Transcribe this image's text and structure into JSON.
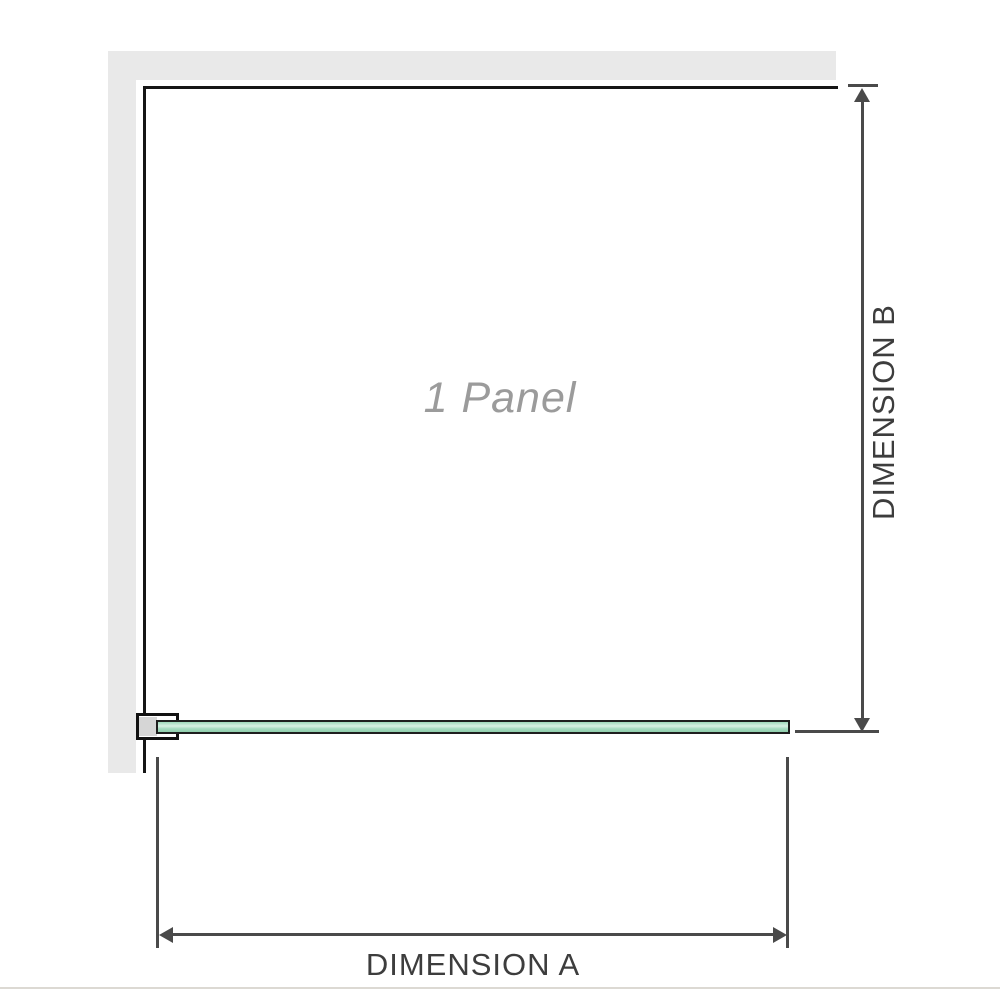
{
  "diagram": {
    "panel_label": "1 Panel",
    "dimension_a_label": "DIMENSION A",
    "dimension_b_label": "DIMENSION B"
  },
  "colors": {
    "background": "#ffffff",
    "wall_fill": "#e9e9e9",
    "panel_outline": "#161616",
    "glass_border": "#1e1e1e",
    "glass_green_light": "#d8f0e3",
    "glass_green": "#a5dabf",
    "glass_green_dark": "#8fceac",
    "bracket_outline": "#111111",
    "bracket_fill": "#ffffff",
    "bracket_insert": "#d6d6d6",
    "dimension_line": "#4a4a4a",
    "dimension_text": "#3d3d3d",
    "panel_text": "#9b9b9b",
    "bottom_rule": "#dcd9d3"
  }
}
